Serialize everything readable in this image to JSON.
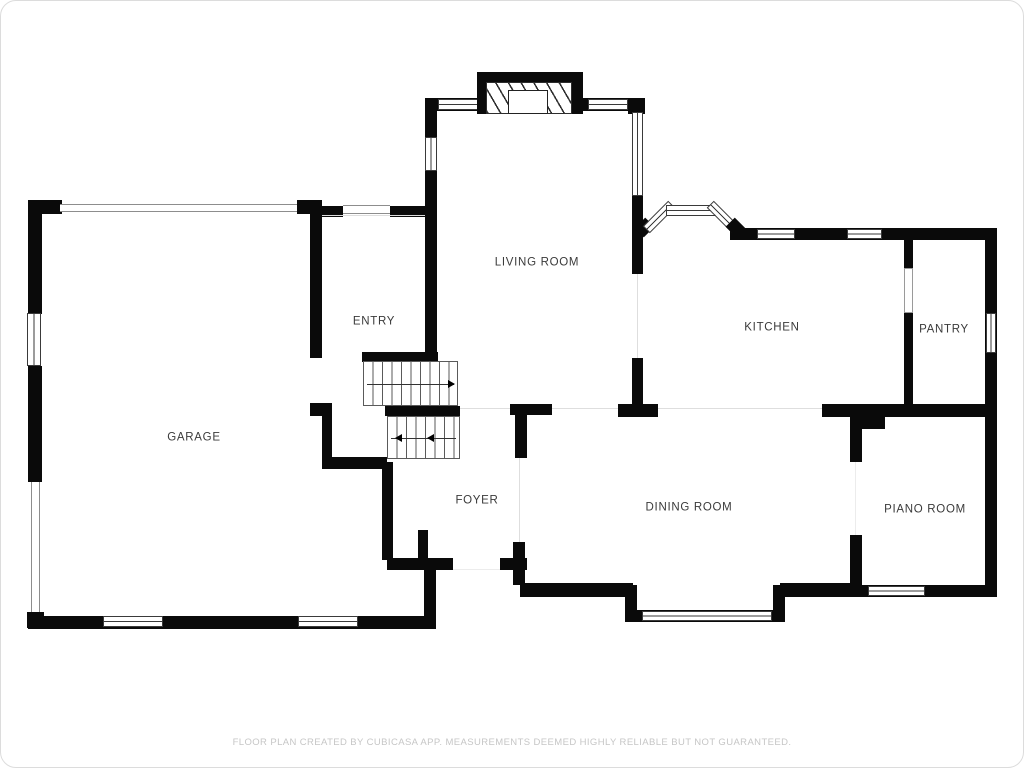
{
  "floorplan": {
    "rooms": [
      {
        "id": "living",
        "label": "LIVING ROOM"
      },
      {
        "id": "entry",
        "label": "ENTRY"
      },
      {
        "id": "kitchen",
        "label": "KITCHEN"
      },
      {
        "id": "pantry",
        "label": "PANTRY"
      },
      {
        "id": "garage",
        "label": "GARAGE"
      },
      {
        "id": "foyer",
        "label": "FOYER"
      },
      {
        "id": "dining",
        "label": "DINING ROOM"
      },
      {
        "id": "piano",
        "label": "PIANO ROOM"
      }
    ],
    "colors": {
      "wall": "#0a0a0a",
      "label_text": "#3a3a3a",
      "opening_line": "#dedede",
      "footer_text": "#c6c6c6"
    },
    "footer_disclaimer": "FLOOR PLAN CREATED BY CUBICASA APP. MEASUREMENTS DEEMED HIGHLY RELIABLE BUT NOT GUARANTEED."
  }
}
